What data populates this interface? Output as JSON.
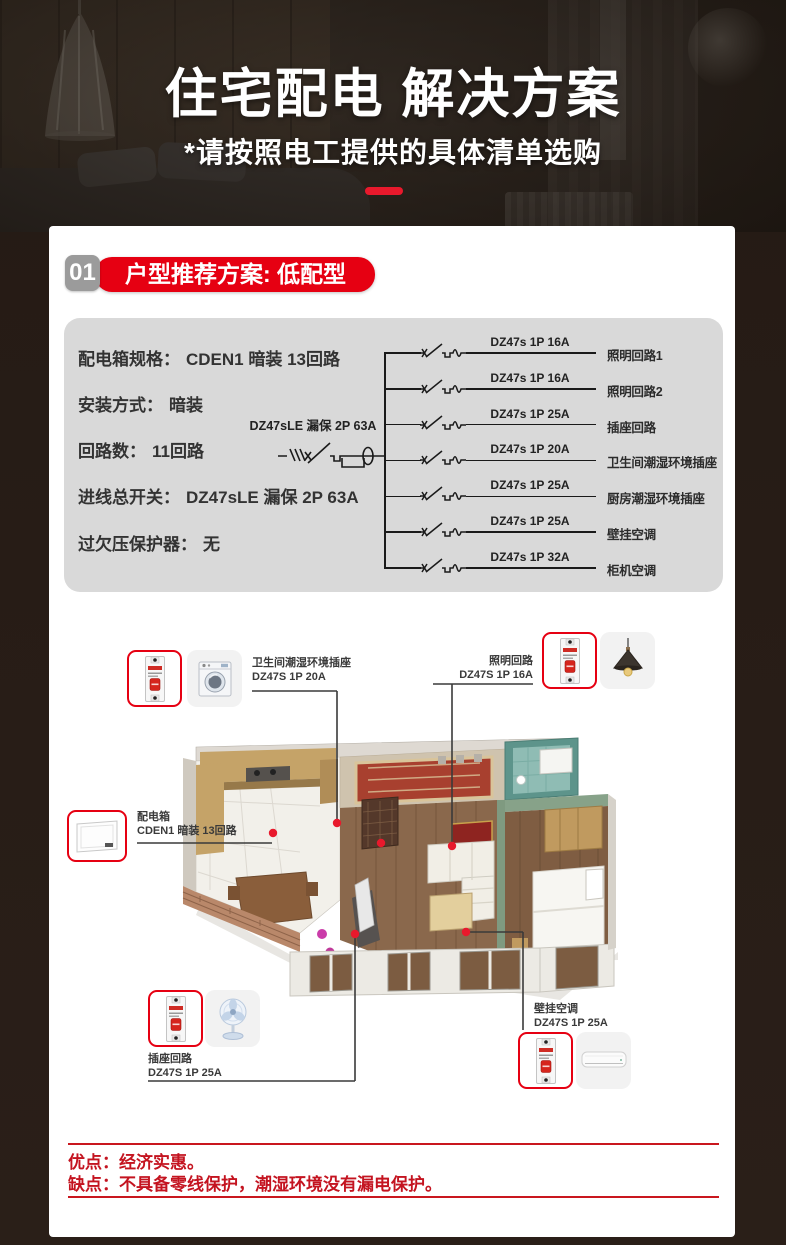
{
  "colors": {
    "accent_red": "#e8192c",
    "pill_red": "#e60012",
    "panel_gray": "#d9d9d9",
    "footer_red": "#c41420",
    "dark_bg": "#281d17"
  },
  "hero": {
    "title": "住宅配电 解决方案",
    "subtitle": "*请按照电工提供的具体清单选购"
  },
  "section": {
    "number": "01",
    "title": "户型推荐方案: 低配型"
  },
  "specs": {
    "rows": [
      {
        "label": "配电箱规格：",
        "value": "CDEN1 暗装 13回路"
      },
      {
        "label": "安装方式：",
        "value": "暗装"
      },
      {
        "label": "回路数：",
        "value": "11回路"
      },
      {
        "label": "进线总开关：",
        "value": "DZ47sLE 漏保 2P 63A"
      },
      {
        "label": "过欠压保护器：",
        "value": "无"
      }
    ]
  },
  "diagram": {
    "main_breaker_label": "DZ47sLE 漏保 2P 63A",
    "branches": [
      {
        "breaker": "DZ47s 1P 16A",
        "circuit": "照明回路1"
      },
      {
        "breaker": "DZ47s 1P 16A",
        "circuit": "照明回路2"
      },
      {
        "breaker": "DZ47s 1P 25A",
        "circuit": "插座回路"
      },
      {
        "breaker": "DZ47s 1P 20A",
        "circuit": "卫生间潮湿环境插座"
      },
      {
        "breaker": "DZ47s 1P 25A",
        "circuit": "厨房潮湿环境插座"
      },
      {
        "breaker": "DZ47s 1P 25A",
        "circuit": "壁挂空调"
      },
      {
        "breaker": "DZ47s 1P 32A",
        "circuit": "柜机空调"
      }
    ]
  },
  "floorplan": {
    "callouts": {
      "bathroom_socket": {
        "line1": "卫生间潮湿环境插座",
        "line2": "DZ47S 1P 20A"
      },
      "lighting": {
        "line1": "照明回路",
        "line2": "DZ47S 1P 16A"
      },
      "distribution_box": {
        "line1": "配电箱",
        "line2": "CDEN1 暗装 13回路"
      },
      "socket": {
        "line1": "插座回路",
        "line2": "DZ47S 1P 25A"
      },
      "wall_ac": {
        "line1": "壁挂空调",
        "line2": "DZ47S 1P 25A"
      }
    }
  },
  "footer": {
    "pros": "优点：经济实惠。",
    "cons": "缺点：不具备零线保护，潮湿环境没有漏电保护。"
  }
}
